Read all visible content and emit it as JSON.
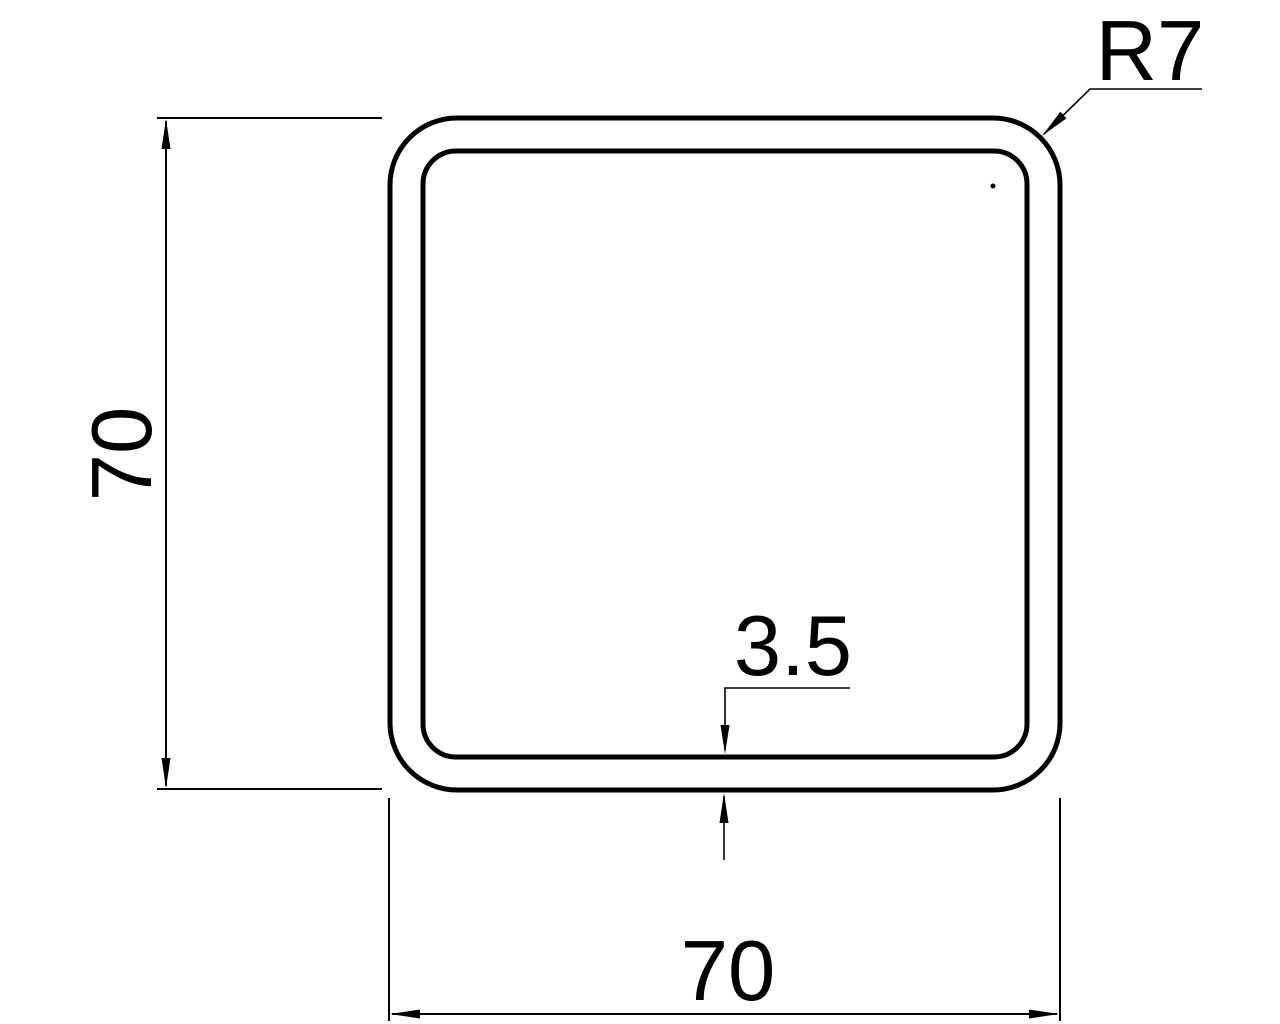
{
  "colors": {
    "background": "#ffffff",
    "line": "#000000"
  },
  "drawing": {
    "description": "Square hollow tube cross-section",
    "labels": {
      "height": "70",
      "width": "70",
      "wall_thickness": "3.5",
      "corner_radius": "R7"
    }
  }
}
